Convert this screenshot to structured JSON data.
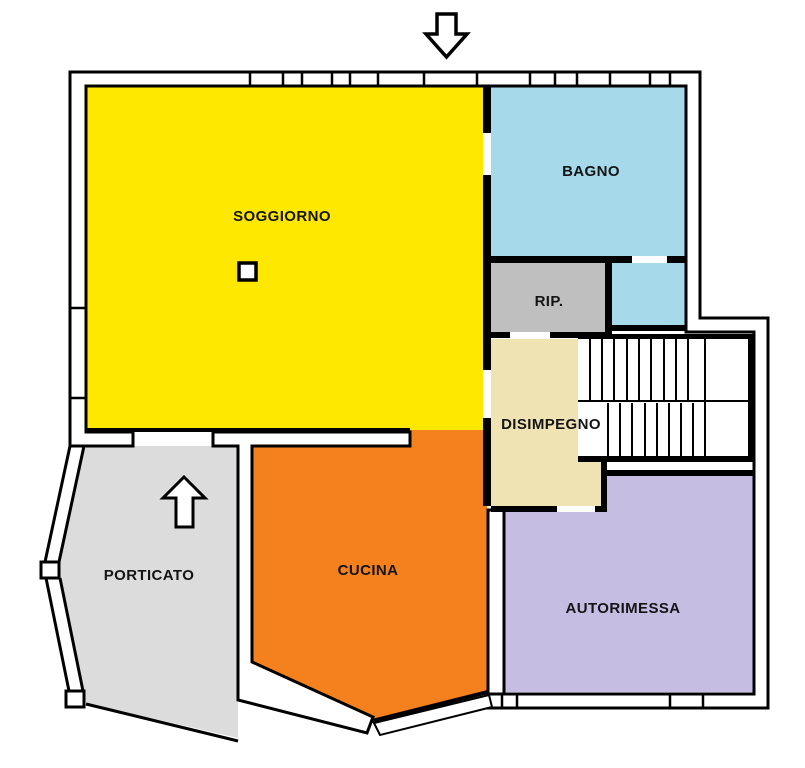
{
  "plan": {
    "rooms": {
      "soggiorno": {
        "label": "SOGGIORNO",
        "color": "#FFE800"
      },
      "bagno": {
        "label": "BAGNO",
        "color": "#A6D9EA"
      },
      "rip": {
        "label": "RIP.",
        "color": "#BFBFBF"
      },
      "disimpegno": {
        "label": "DISIMPEGNO",
        "color": "#EFE3B4"
      },
      "cucina": {
        "label": "CUCINA",
        "color": "#F4801E"
      },
      "porticato": {
        "label": "PORTICATO",
        "color": "#DCDCDC"
      },
      "autorimessa": {
        "label": "AUTORIMESSA",
        "color": "#C6BDE3"
      }
    },
    "walls": {
      "stroke": "#000000",
      "fill": "#FFFFFF"
    },
    "icons": {
      "top_entrance": "down-arrow",
      "porch_entrance": "up-arrow"
    },
    "text_color": "#141414"
  }
}
